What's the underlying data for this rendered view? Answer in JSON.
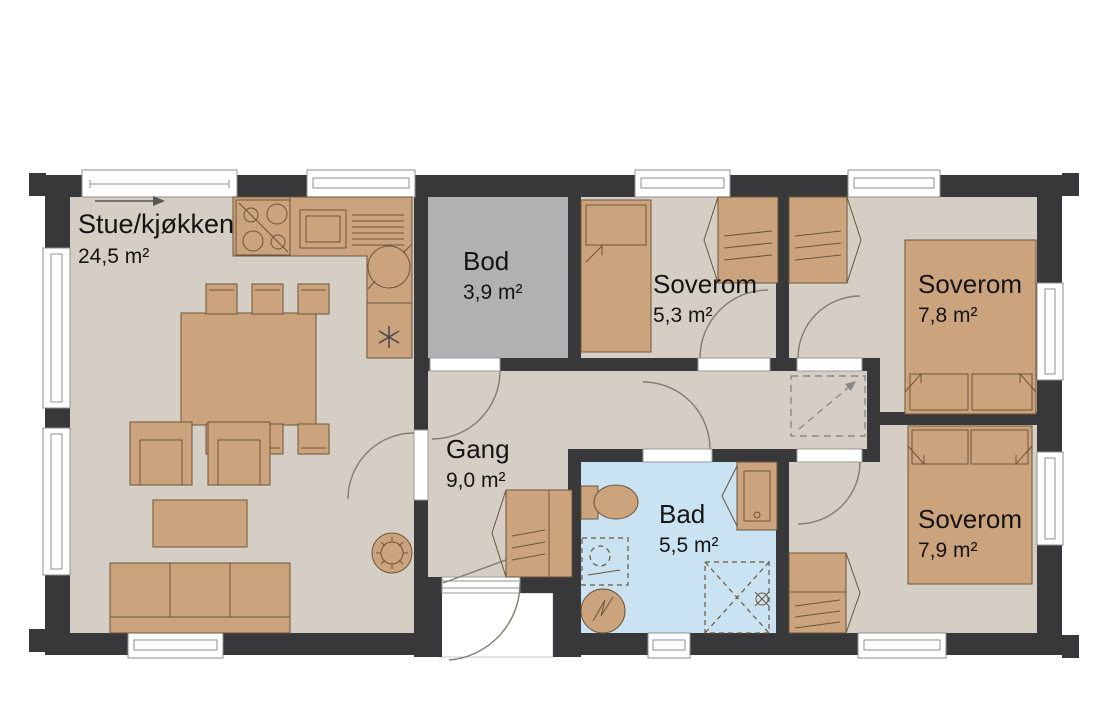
{
  "floorplan": {
    "rooms": [
      {
        "name": "Stue/kjøkken",
        "area": "24,5 m²"
      },
      {
        "name": "Bod",
        "area": "3,9 m²"
      },
      {
        "name": "Soverom",
        "area": "5,3 m²"
      },
      {
        "name": "Soverom",
        "area": "7,8 m²"
      },
      {
        "name": "Gang",
        "area": "9,0 m²"
      },
      {
        "name": "Bad",
        "area": "5,5 m²"
      },
      {
        "name": "Soverom",
        "area": "7,9 m²"
      }
    ],
    "colors": {
      "wall": "#38383a",
      "floor": "#d5cec5",
      "bod_floor": "#b1b1b3",
      "bath_floor": "#c9e3f2",
      "furniture": "#cba37d",
      "outline": "#6d5539",
      "background": "#ffffff"
    },
    "symbols": [
      "stove-icon",
      "sink-icon",
      "fridge-icon",
      "wood-stove-icon",
      "toilet-icon",
      "vanity-sink-icon",
      "washing-machine-icon",
      "water-heater-icon",
      "shower-icon",
      "attic-hatch-icon",
      "wardrobe-icon",
      "bed-icon",
      "sofa-icon",
      "armchair-icon",
      "coffee-table-icon",
      "dining-table-icon",
      "sliding-door-arrow-icon",
      "door-swing-icon",
      "window-icon"
    ]
  }
}
